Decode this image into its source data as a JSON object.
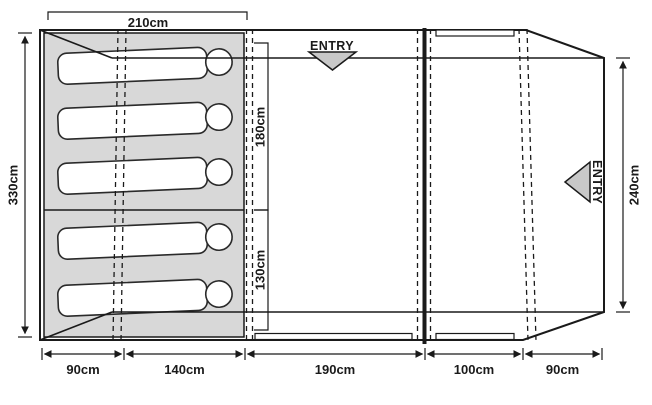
{
  "diagram": {
    "type": "tent-floorplan-top-view",
    "entry_labels": {
      "top": "ENTRY",
      "right": "ENTRY"
    },
    "dimensions": {
      "cabin_width": "210cm",
      "tent_depth": "330cm",
      "bedroom_main_depth": "180cm",
      "bedroom_small_depth": "130cm",
      "porch_depth": "240cm",
      "bottom_segments": [
        "90cm",
        "140cm",
        "190cm",
        "100cm",
        "90cm"
      ]
    },
    "sleeper_count": 5,
    "colors": {
      "cabin_fill": "#d8d8d8",
      "entry_triangle_fill": "#c8c8c8",
      "line": "#1a1a1a"
    }
  }
}
